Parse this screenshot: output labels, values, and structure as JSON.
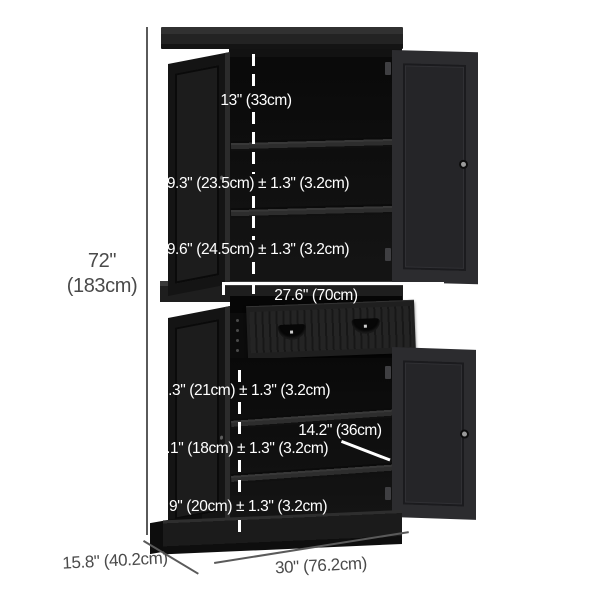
{
  "diagram": {
    "subject": "black freestanding kitchen pantry cabinet with 4 doors, 1 drawer and interior shelves",
    "style": "product dimension diagram",
    "colors": {
      "cabinet_black": "#1b1b1b",
      "outside_annotation_text": "#4a4a4a",
      "outside_annotation_line": "#5a5a5a",
      "inside_annotation": "#ffffff",
      "background": "#ffffff"
    }
  },
  "dimensions": {
    "overall_height": {
      "line1": "72\"",
      "line2": "(183cm)"
    },
    "overall_depth": "15.8\" (40.2cm)",
    "overall_width": "30\" (76.2cm)",
    "top_opening_height": "13\" (33cm)",
    "upper_shelf_spacing_1": "9.3\" (23.5cm) ± 1.3\" (3.2cm)",
    "upper_shelf_spacing_2": "9.6\" (24.5cm) ± 1.3\" (3.2cm)",
    "drawer_width": "27.6\" (70cm)",
    "lower_shelf_spacing_1": "8.3\" (21cm) ± 1.3\" (3.2cm)",
    "shelf_depth": "14.2\" (36cm)",
    "lower_shelf_spacing_2": "7.1\" (18cm) ± 1.3\" (3.2cm)",
    "lower_shelf_spacing_3": "7.9\" (20cm) ± 1.3\" (3.2cm)"
  }
}
